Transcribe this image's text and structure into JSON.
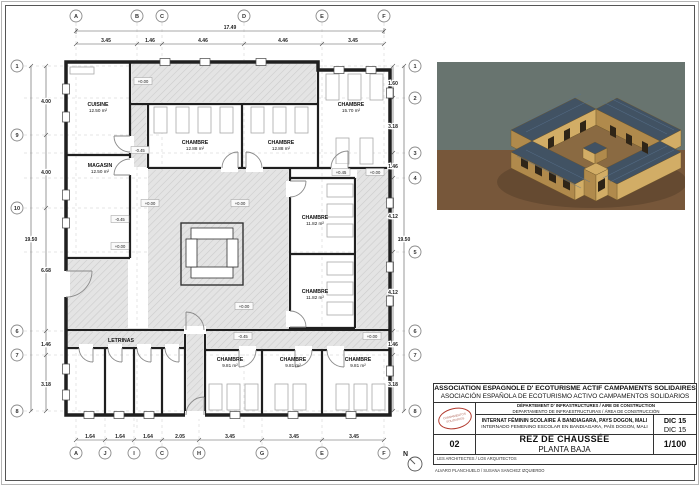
{
  "sheet": {
    "bg": "#ffffff",
    "frame": "#555555"
  },
  "plan": {
    "grid_top": [
      "A",
      "B",
      "C",
      "D",
      "E",
      "F"
    ],
    "grid_bottom": [
      "A",
      "J",
      "I",
      "C",
      "H",
      "G",
      "E",
      "F"
    ],
    "grid_left": [
      "1",
      "9",
      "10",
      "6",
      "7",
      "8"
    ],
    "grid_right": [
      "1",
      "2",
      "3",
      "4",
      "5",
      "6",
      "7",
      "8"
    ],
    "dims": {
      "top_total": "17.49",
      "top": [
        "3.45",
        "1.46",
        "4.46",
        "4.46",
        "3.45"
      ],
      "bottom": [
        "1.64",
        "1.64",
        "1.64",
        "2.05",
        "3.45",
        "3.45",
        "3.45"
      ],
      "left_total": "19.50",
      "left": [
        "4.00",
        "4.00",
        "6.68",
        "1.46",
        "3.18"
      ],
      "right_total": "19.50",
      "right": [
        "1.60",
        "3.18",
        "1.46",
        "4.12",
        "4.12",
        "1.46",
        "3.18"
      ]
    },
    "rooms": [
      {
        "name": "CUISINE",
        "area": "12.50 m²"
      },
      {
        "name": "MAGASIN",
        "area": "12.50 m²"
      },
      {
        "name": "CHAMBRE",
        "area": "12.88 m²"
      },
      {
        "name": "CHAMBRE",
        "area": "12.88 m²"
      },
      {
        "name": "CHAMBRE",
        "area": "15.70 m²"
      },
      {
        "name": "CHAMBRE",
        "area": "11.82 m²"
      },
      {
        "name": "CHAMBRE",
        "area": "11.82 m²"
      },
      {
        "name": "LETRINAS",
        "area": ""
      },
      {
        "name": "CHAMBRE",
        "area": "9.81 m²"
      },
      {
        "name": "CHAMBRE",
        "area": "9.81 m²"
      },
      {
        "name": "CHAMBRE",
        "area": "9.81 m²"
      }
    ],
    "levels": [
      "+0.00",
      "-0.45",
      "+0.45",
      "+0.00",
      "+0.00",
      "+0.00",
      "-0.45",
      "+0.00",
      "+0.00",
      "-0.45",
      "+0.00"
    ],
    "north": "N"
  },
  "render3d": {
    "sky": "#68746f",
    "ground": "#77573a",
    "wall_light": "#d2ad66",
    "wall_shadow": "#b08a4c",
    "roof": "#415263",
    "court": "#8a6a42"
  },
  "titleblock": {
    "org_fr": "ASSOCIATION ESPAGNOLE D' ECOTURISME ACTIF CAMPAMENTS SOLIDAIRES",
    "org_es": "ASOCIACIÓN ESPAÑOLA DE ECOTURISMO ACTIVO CAMPAMENTOS SOLIDARIOS",
    "dept_fr": "DÉPARTEMENT D' INFRASTRUCTURES / AIRE DE CONSTRUCTION",
    "dept_es": "DEPARTAMENTO DE INFRAESTRUCTURAS / ÁREA DE CONSTRUCCIÓN",
    "project_fr": "INTERNAT FÉMININ SCOLAIRE Á BANDIAGARA, PAYS DOGON, MALI",
    "project_es": "INTERNADO FEMENINO ESCOLAR EN BANDIAGARA, PAÍS DOGON, MALI",
    "date_fr": "DIC 15",
    "date_es": "DIC 15",
    "sheet_number": "02",
    "title_fr": "REZ DE CHAUSSÉE",
    "title_es": "PLANTA BAJA",
    "scale": "1/100",
    "architects_label": "LES ARCHITECTES / LOS ARQUITECTOS",
    "architects_names": "ALVARO PLANCHUELO / SUSANA SANCHEZ IZQUIERDO",
    "logo_line1": "CAMPAMENTOS",
    "logo_line2": "SOLIDARIOS"
  }
}
